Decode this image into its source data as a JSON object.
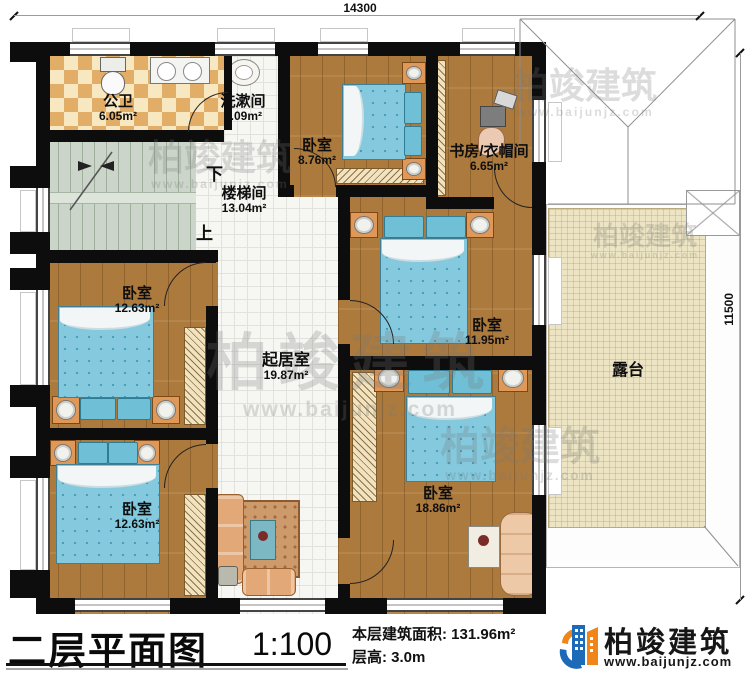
{
  "plan": {
    "dimensions": {
      "top": "14300",
      "right": "11500"
    },
    "stairs": {
      "down_label": "下",
      "up_label": "上"
    },
    "rooms": {
      "bathroom": {
        "name": "公卫",
        "area": "6.05m²"
      },
      "washroom": {
        "name": "洗漱间",
        "area": "2.09m²"
      },
      "stairwell": {
        "name": "楼梯间",
        "area": "13.04m²"
      },
      "bedroom_top": {
        "name": "卧室",
        "area": "8.76m²"
      },
      "study": {
        "name": "书房/衣帽间",
        "area": "6.65m²"
      },
      "bedroom_mid_left": {
        "name": "卧室",
        "area": "12.63m²"
      },
      "living": {
        "name": "起居室",
        "area": "19.87m²"
      },
      "bedroom_mid_right": {
        "name": "卧室",
        "area": "11.95m²"
      },
      "terrace": {
        "name": "露台"
      },
      "bedroom_bottom_left": {
        "name": "卧室",
        "area": "12.63m²"
      },
      "bedroom_bottom_right": {
        "name": "卧室",
        "area": "18.86m²"
      }
    }
  },
  "titlebar": {
    "title": "二层平面图",
    "scale": "1:100",
    "floor_area": "本层建筑面积: 131.96m²",
    "floor_height": "层高: 3.0m"
  },
  "logo": {
    "name": "柏竣建筑",
    "url": "www.baijunjz.com"
  },
  "watermark": {
    "text": "柏竣建筑",
    "url": "www.baijunjz.com"
  },
  "colors": {
    "wall": "#0d0d0d",
    "wood_floor": "#ac7a3d",
    "bed_blue": "#84c9dd",
    "hall_tile": "#f6f6f3",
    "terrace": "#ece4c2",
    "stair": "#ccd5c9",
    "checker_a": "#e2ad66",
    "checker_b": "#f7e8c2",
    "logo_blue": "#1d6ab8",
    "logo_orange": "#f08519"
  }
}
